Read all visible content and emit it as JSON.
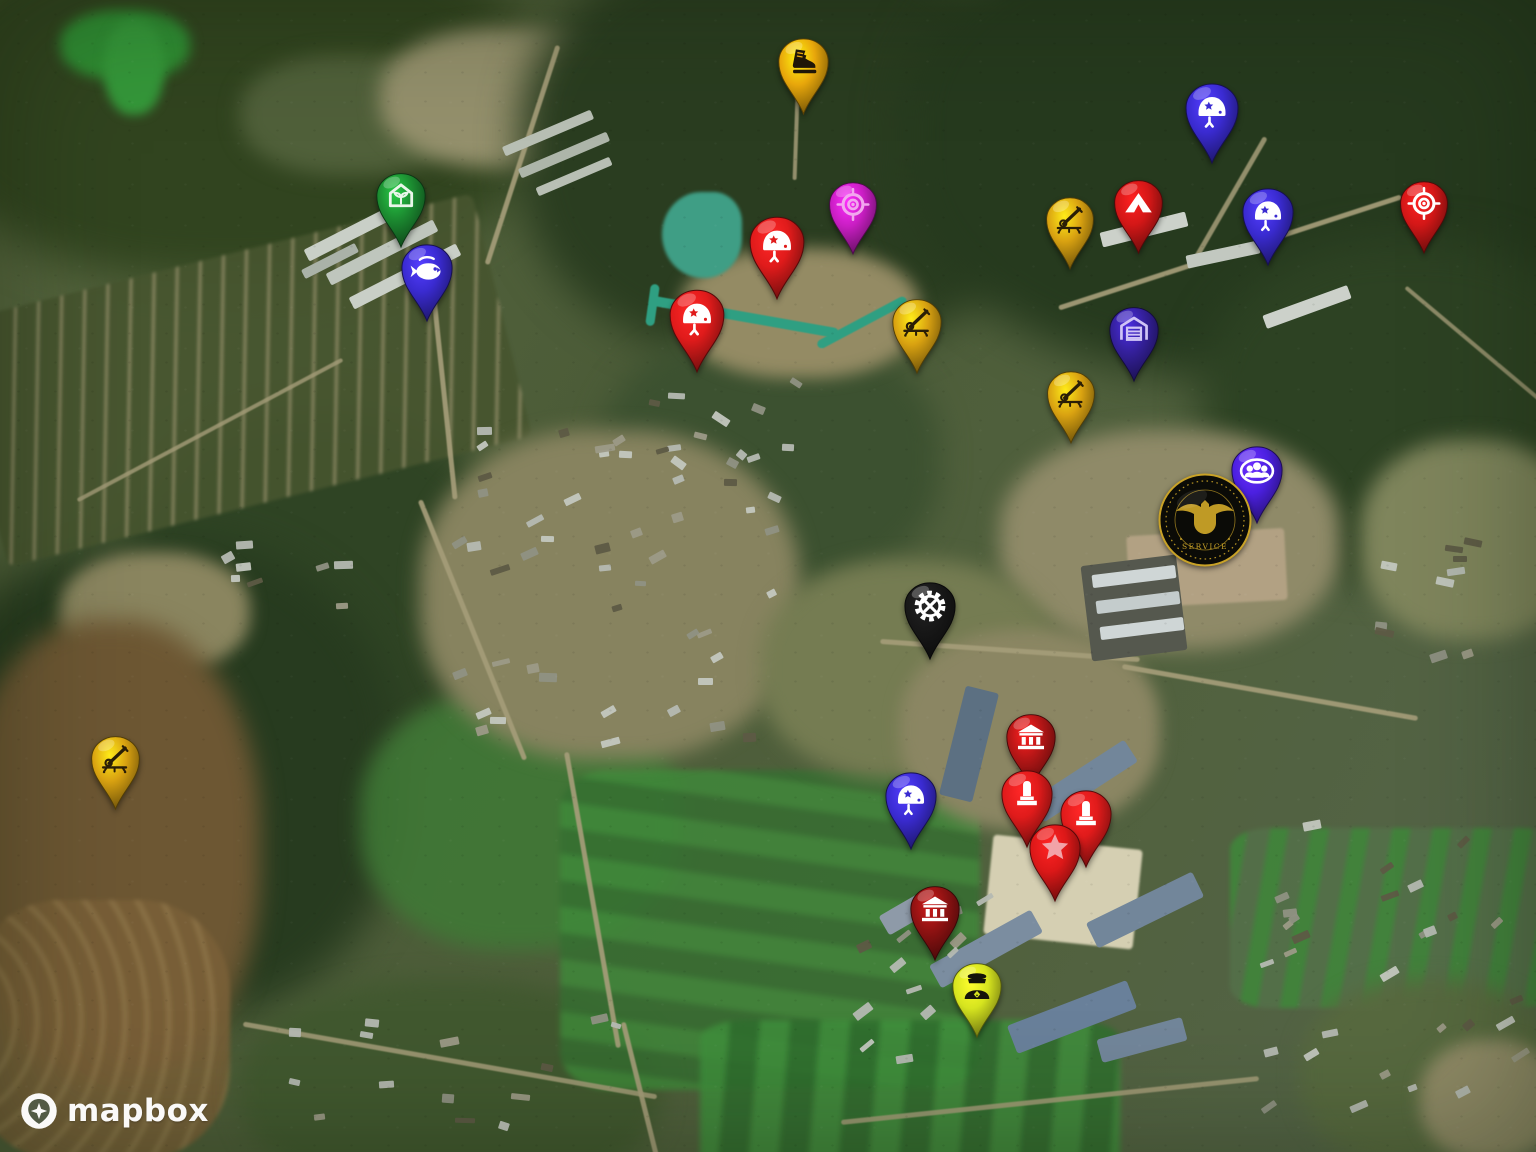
{
  "map": {
    "provider": "Mapbox",
    "style": "satellite",
    "description": "Satellite imagery of a rural valley with a military facility, annotated with category markers"
  },
  "attribution": {
    "logo_text": "mapbox"
  },
  "colors": {
    "gold": "#D9A211",
    "amber": "#E8A70B",
    "green": "#1C8C31",
    "indigo_blue": "#3A2BD1",
    "violet": "#4B20E0",
    "dark_indigo": "#34209B",
    "magenta": "#C91EC3",
    "bright_red": "#E01B1B",
    "red": "#D31717",
    "dark_red": "#B31616",
    "maroon": "#8E1212",
    "black": "#181818",
    "chartreuse": "#D6E41F",
    "seal_gold": "#C9A227"
  },
  "markers": [
    {
      "name": "boot-marker",
      "icon": "boot",
      "pin": "#E8A70B",
      "glyph": "#1F1608",
      "cx": 803,
      "cy": 62,
      "w": 57
    },
    {
      "name": "greenhouse-marker",
      "icon": "greenhouse",
      "pin": "#1C8C31",
      "glyph": "#EAF6EA",
      "cx": 401,
      "cy": 196,
      "w": 56
    },
    {
      "name": "fishery-marker",
      "icon": "fish",
      "pin": "#3A2BD1",
      "glyph": "#FFFFFF",
      "cx": 427,
      "cy": 268,
      "w": 58
    },
    {
      "name": "target-marker-magenta",
      "icon": "target",
      "pin": "#C91EC3",
      "glyph": "#F2A6EE",
      "cx": 853,
      "cy": 204,
      "w": 54
    },
    {
      "name": "helmet-marker-red-1",
      "icon": "helmet",
      "pin": "#E01B1B",
      "glyph": "#FFFFFF",
      "cx": 777,
      "cy": 242,
      "w": 62
    },
    {
      "name": "helmet-marker-red-2",
      "icon": "helmet",
      "pin": "#E01B1B",
      "glyph": "#FFFFFF",
      "cx": 697,
      "cy": 315,
      "w": 62
    },
    {
      "name": "aa-gun-marker-1",
      "icon": "aa-gun",
      "pin": "#D9A211",
      "glyph": "#2A1E06",
      "cx": 917,
      "cy": 322,
      "w": 56
    },
    {
      "name": "aa-gun-marker-2",
      "icon": "aa-gun",
      "pin": "#D9A211",
      "glyph": "#2A1E06",
      "cx": 1070,
      "cy": 219,
      "w": 54
    },
    {
      "name": "tent-marker",
      "icon": "tent",
      "pin": "#D31717",
      "glyph": "#FFFFFF",
      "cx": 1138,
      "cy": 203,
      "w": 55
    },
    {
      "name": "helmet-marker-blue-1",
      "icon": "helmet",
      "pin": "#3A2BD1",
      "glyph": "#FFFFFF",
      "cx": 1212,
      "cy": 108,
      "w": 60
    },
    {
      "name": "helmet-marker-blue-2",
      "icon": "helmet",
      "pin": "#3A2BD1",
      "glyph": "#FFFFFF",
      "cx": 1268,
      "cy": 212,
      "w": 58
    },
    {
      "name": "target-marker-red",
      "icon": "target",
      "pin": "#D31717",
      "glyph": "#FFFFFF",
      "cx": 1424,
      "cy": 203,
      "w": 54
    },
    {
      "name": "garage-marker",
      "icon": "garage",
      "pin": "#34209B",
      "glyph": "#CFC4F6",
      "cx": 1134,
      "cy": 330,
      "w": 56
    },
    {
      "name": "aa-gun-marker-3",
      "icon": "aa-gun",
      "pin": "#D9A211",
      "glyph": "#2A1E06",
      "cx": 1071,
      "cy": 393,
      "w": 54
    },
    {
      "name": "personnel-marker",
      "icon": "people",
      "pin": "#4B20E0",
      "glyph": "#FFFFFF",
      "cx": 1257,
      "cy": 470,
      "w": 58
    },
    {
      "name": "industry-marker",
      "icon": "gear",
      "pin": "#181818",
      "glyph": "#FFFFFF",
      "cx": 930,
      "cy": 606,
      "w": 58
    },
    {
      "name": "bank-marker-1",
      "icon": "bank",
      "pin": "#B31616",
      "glyph": "#FFFFFF",
      "cx": 1031,
      "cy": 737,
      "w": 56
    },
    {
      "name": "helmet-marker-blue-3",
      "icon": "helmet",
      "pin": "#3A2BD1",
      "glyph": "#FFFFFF",
      "cx": 911,
      "cy": 796,
      "w": 58
    },
    {
      "name": "monument-marker-1",
      "icon": "monument",
      "pin": "#E01B1B",
      "glyph": "#FFFFFF",
      "cx": 1027,
      "cy": 794,
      "w": 58
    },
    {
      "name": "monument-marker-2",
      "icon": "monument",
      "pin": "#E01B1B",
      "glyph": "#FFFFFF",
      "cx": 1086,
      "cy": 814,
      "w": 58
    },
    {
      "name": "star-marker",
      "icon": "star",
      "pin": "#DC1818",
      "glyph": "#F2A3A8",
      "cx": 1055,
      "cy": 848,
      "w": 58
    },
    {
      "name": "bank-marker-2",
      "icon": "bank",
      "pin": "#8E1212",
      "glyph": "#FFFFFF",
      "cx": 935,
      "cy": 909,
      "w": 56
    },
    {
      "name": "officer-marker",
      "icon": "officer",
      "pin": "#D6E41F",
      "glyph": "#15150A",
      "cx": 977,
      "cy": 986,
      "w": 56
    },
    {
      "name": "aa-gun-marker-4",
      "icon": "aa-gun",
      "pin": "#D9A211",
      "glyph": "#2A1E06",
      "cx": 115,
      "cy": 759,
      "w": 55
    }
  ],
  "badge": {
    "name": "intelligence-service-seal",
    "cx": 1205,
    "cy": 520,
    "r": 47,
    "bg": "#0B0B07",
    "ring": "#C9A227",
    "text": "SERVICE"
  }
}
